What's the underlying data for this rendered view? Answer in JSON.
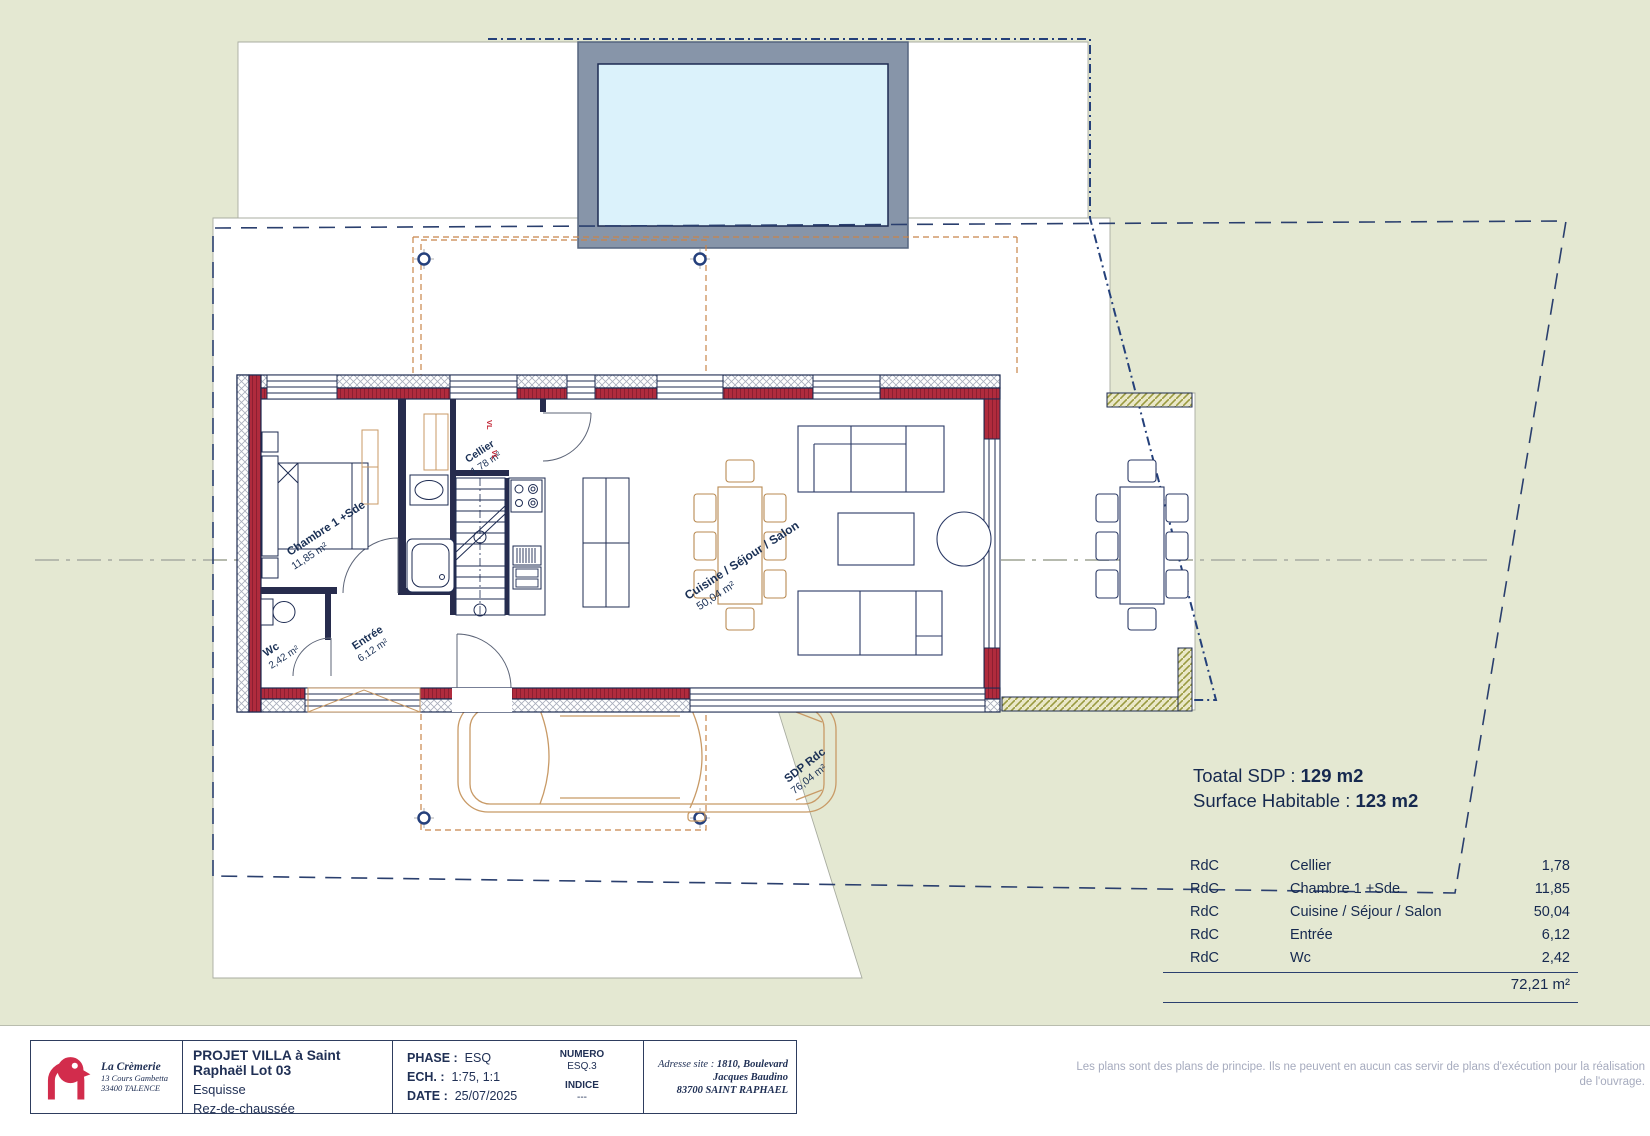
{
  "plan": {
    "labels": {
      "chambre": {
        "name": "Chambre 1 +Sde",
        "area": "11,85 m²"
      },
      "wc": {
        "name": "Wc",
        "area": "2,42 m²"
      },
      "entree": {
        "name": "Entrée",
        "area": "6,12 m²"
      },
      "cellier": {
        "name": "Cellier",
        "area": "1,78 m²"
      },
      "cuisine": {
        "name": "Cuisine / Séjour / Salon",
        "area": "50,04 m²"
      },
      "sdp": {
        "name": "SDP Rdc",
        "area": "76,04 m²"
      },
      "vl": "VL"
    },
    "colors": {
      "background_green": "#e4e8d2",
      "wall_red": "#b02b3d",
      "line_navy": "#1d2b52",
      "pool_water": "#dbf2fb",
      "pool_deck": "#8795a9",
      "roof_dash_orange": "#c8854a",
      "furniture_tan": "#b98a52",
      "olive_wall": "#9a9a40"
    }
  },
  "summary": {
    "total_sdp_label": "Toatal SDP : ",
    "total_sdp_value": "129 m2",
    "habitable_label": "Surface Habitable : ",
    "habitable_value": "123 m2",
    "rows": [
      {
        "level": "RdC",
        "room": "Cellier",
        "area": "1,78"
      },
      {
        "level": "RdC",
        "room": "Chambre 1 +Sde",
        "area": "11,85"
      },
      {
        "level": "RdC",
        "room": "Cuisine / Séjour / Salon",
        "area": "50,04"
      },
      {
        "level": "RdC",
        "room": "Entrée",
        "area": "6,12"
      },
      {
        "level": "RdC",
        "room": "Wc",
        "area": "2,42"
      }
    ],
    "total_area": "72,21 m²"
  },
  "title_block": {
    "company": {
      "name": "La Crèmerie",
      "address_line1": "13 Cours Gambetta",
      "address_line2": "33400 TALENCE"
    },
    "project_title": "PROJET VILLA à Saint Raphaël Lot 03",
    "phase_name": "Esquisse",
    "level_name": "Rez-de-chaussée",
    "phase_label": "PHASE :",
    "phase_value": "ESQ",
    "scale_label": "ECH. :",
    "scale_value": "1:75, 1:1",
    "date_label": "DATE :",
    "date_value": "25/07/2025",
    "numero_label": "NUMERO",
    "numero_value": "ESQ.3",
    "indice_label": "INDICE",
    "indice_value": "---",
    "site_label": "Adresse site : ",
    "site_address": "1810, Boulevard Jacques Baudino",
    "site_city": "83700 SAINT RAPHAEL"
  },
  "disclaimer": "Les plans sont des plans de principe. Ils ne peuvent en aucun cas servir de plans d'exécution pour la réalisation de l'ouvrage."
}
